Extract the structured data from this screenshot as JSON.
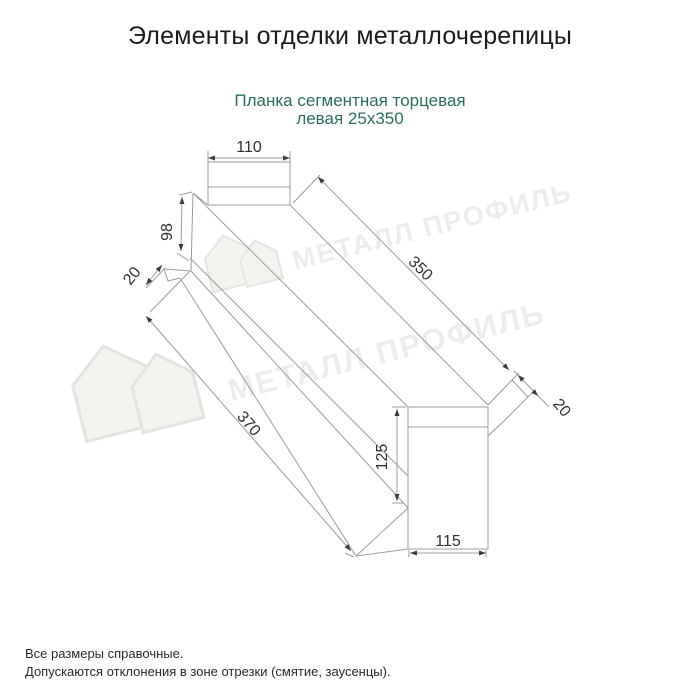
{
  "header": {
    "title": "Элементы отделки металлочерепицы",
    "subtitle_line1": "Планка сегментная торцевая",
    "subtitle_line2": "левая 25х350"
  },
  "dimensions": {
    "top_width": "110",
    "left_face": "98",
    "left_fold": "20",
    "length_inner": "350",
    "length_outer": "370",
    "right_fold": "20",
    "bottom_height": "125",
    "bottom_width": "115"
  },
  "watermark": {
    "brand": "МЕТАЛЛ ПРОФИЛЬ"
  },
  "footer": {
    "note1": "Все размеры справочные.",
    "note2": "Допускаются отклонения в зоне отрезки (смятие, заусенцы)."
  },
  "colors": {
    "subtitle": "#2e6b5f",
    "drawing_line": "#9c9c98",
    "dimension_text": "#2f2f2f",
    "arrow": "#3a3a3a",
    "watermark": "#ececea"
  }
}
